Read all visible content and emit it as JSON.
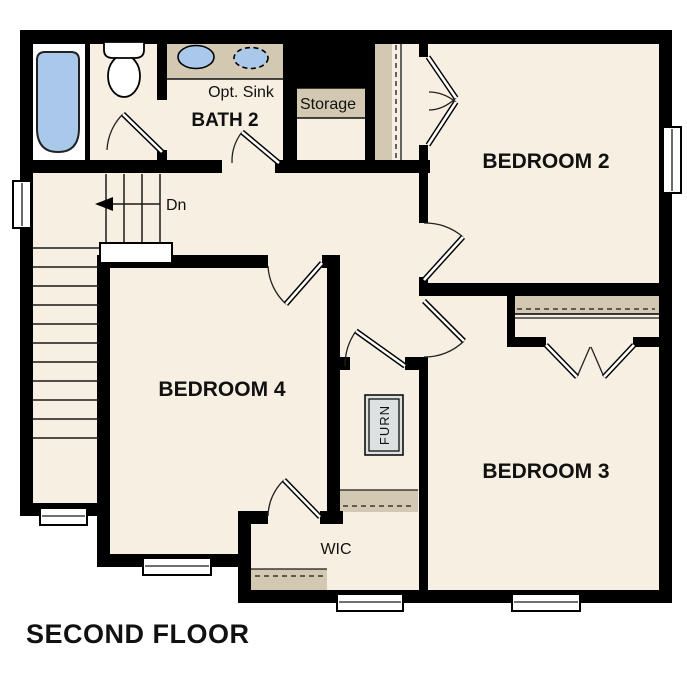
{
  "plan": {
    "title": "SECOND FLOOR",
    "labels": {
      "bath2": "BATH 2",
      "opt_sink": "Opt. Sink",
      "storage": "Storage",
      "bedroom2": "BEDROOM 2",
      "bedroom4": "BEDROOM 4",
      "bedroom3": "BEDROOM 3",
      "wic": "WIC",
      "furnace": "FURN",
      "stairs_direction": "Dn"
    },
    "colors": {
      "background": "#ffffff",
      "floor": "#f6efe2",
      "wall": "#000000",
      "casework": "#d3c8b2",
      "plumbing_blue": "#aac9ea",
      "furnace_fill": "#dde1e2",
      "text": "#111111"
    }
  }
}
